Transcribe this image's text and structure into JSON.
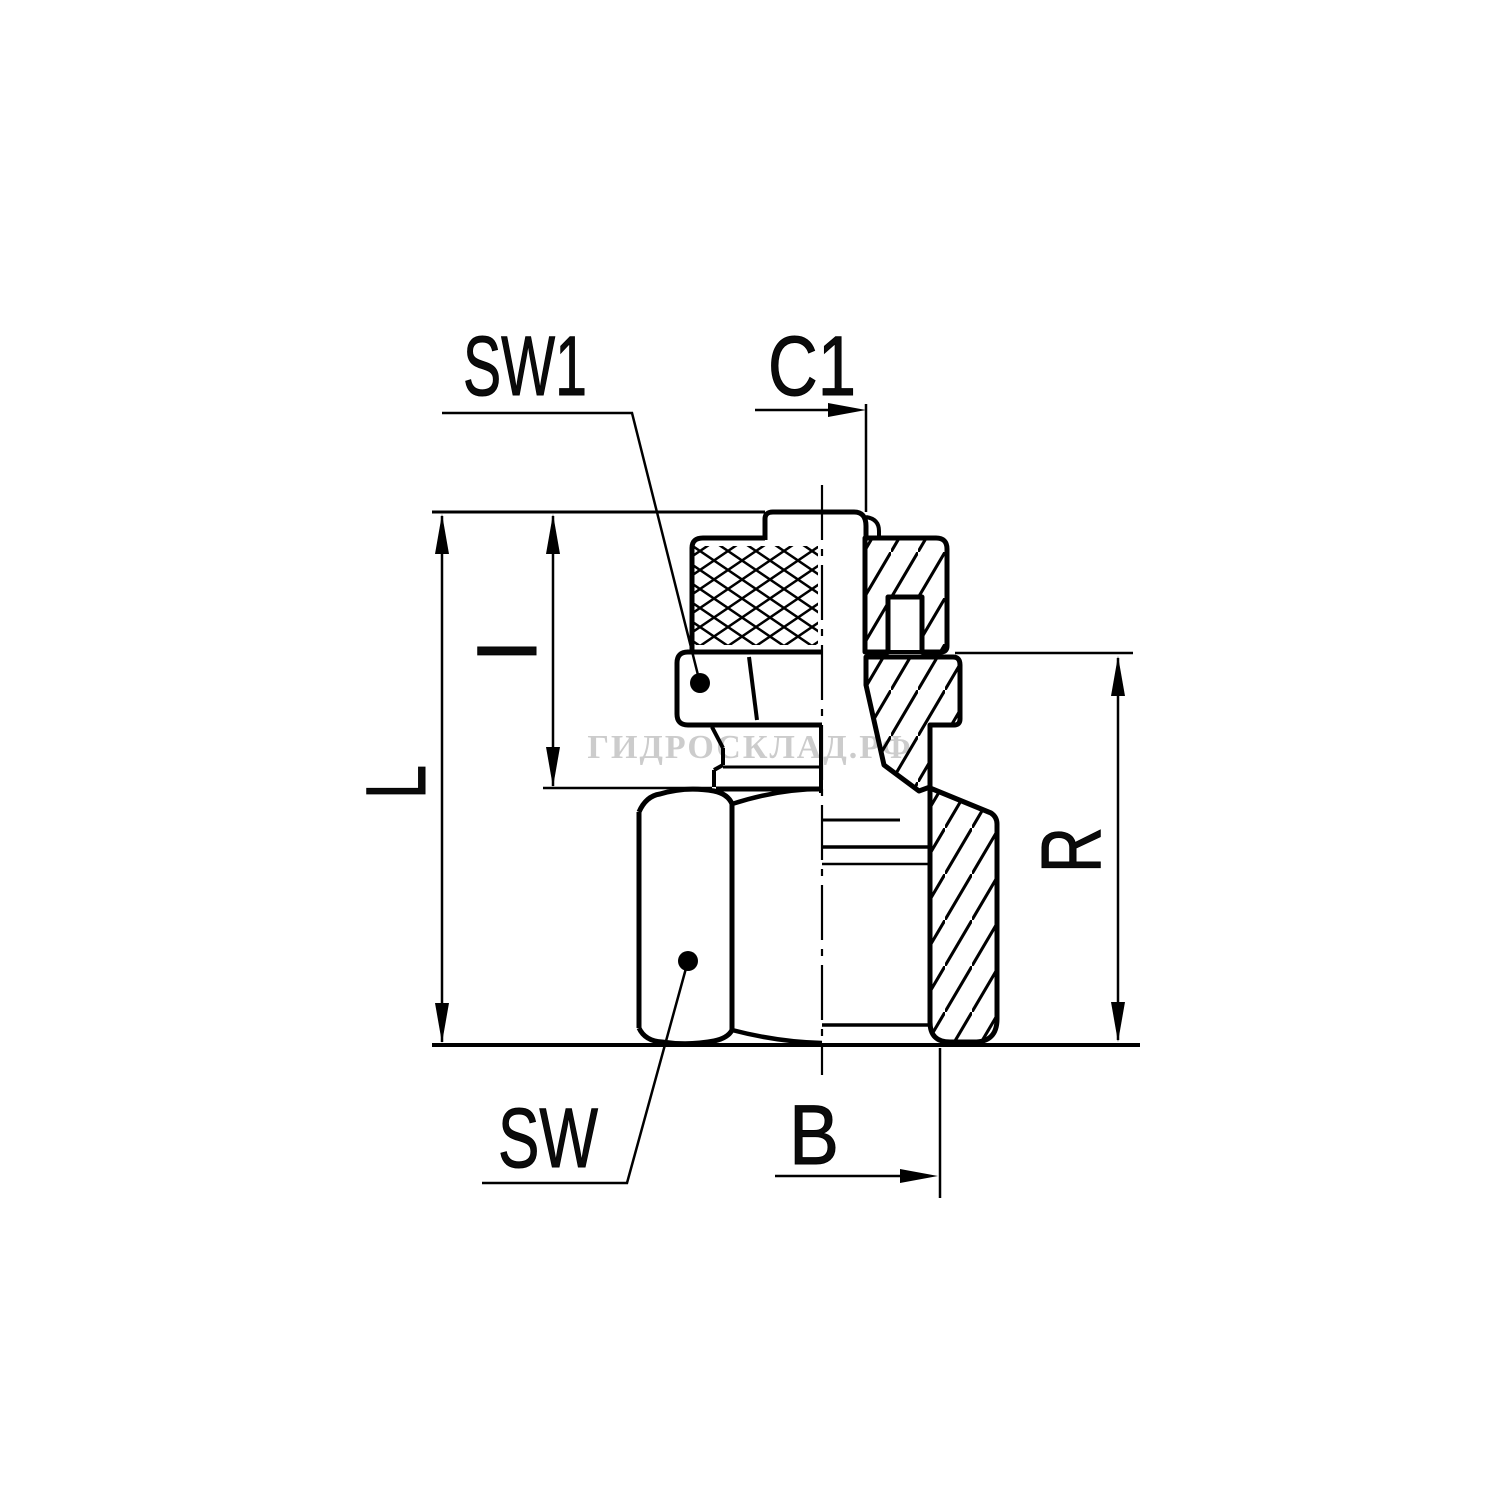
{
  "page": {
    "background_color": "#ffffff"
  },
  "drawing": {
    "kind": "engineering half-section drawing of a swivel tube fitting",
    "line_color": "#000000",
    "watermark": {
      "text": "ГИДРОСКЛАД.РФ",
      "color": "#b9b9b9"
    },
    "dimension_labels": {
      "sw1": "SW1",
      "c1": "C1",
      "i": "I",
      "l": "L",
      "r": "R",
      "sw": "SW",
      "b": "B"
    }
  }
}
